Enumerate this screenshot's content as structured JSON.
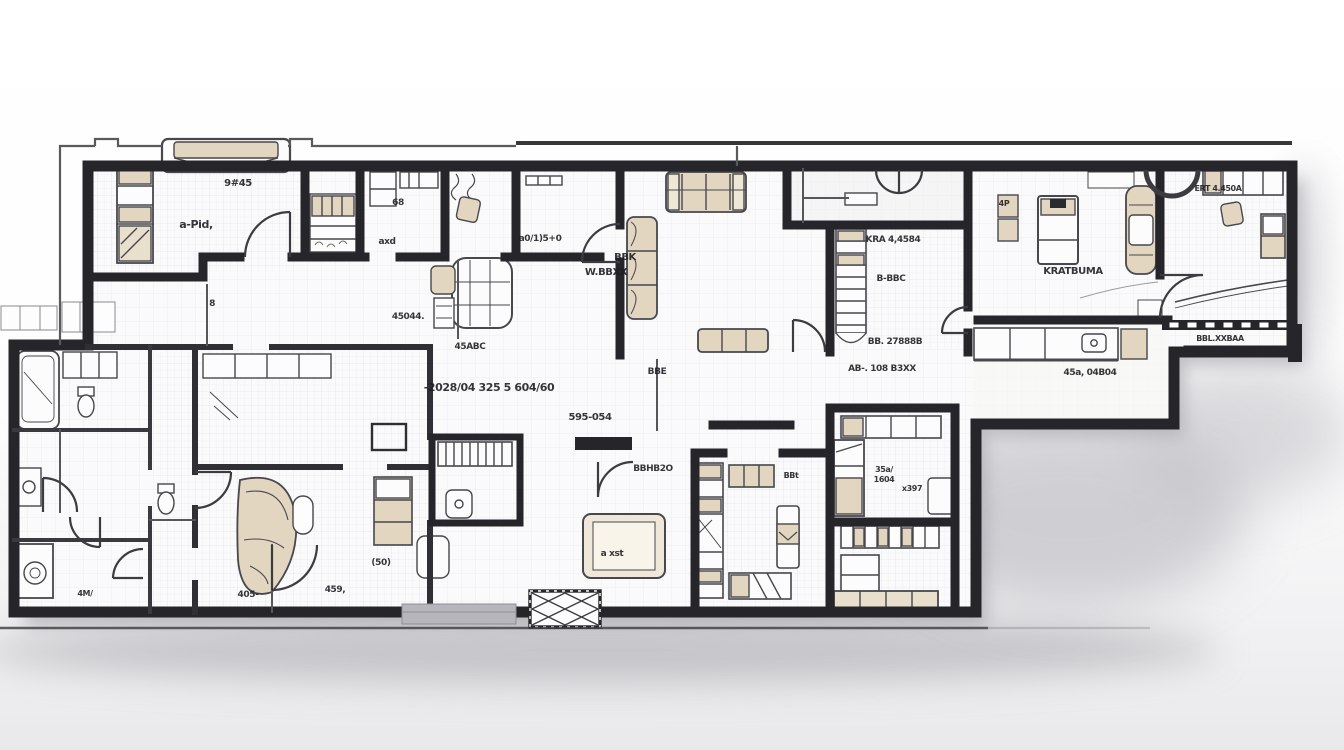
{
  "meta": {
    "title": "Hand-sketched apartment floor plan"
  },
  "palette": {
    "wall": "#26262a",
    "wall_medium": "#3a3a3e",
    "thin_line": "#55555a",
    "floor": "#fbfafb",
    "grid": "#aebad2",
    "furniture_beige": "#e3d6c1",
    "furniture_tan": "#d8c7ab",
    "furniture_white": "#fcfcfd",
    "furniture_stroke": "#47474c",
    "shadow": "#9b9ba1",
    "threshold_gray": "#b6b6bc",
    "label_ink": "#1e1e22"
  },
  "floorplan": {
    "labels": [
      {
        "name": "label-bedroom1-dim",
        "text": "9#45",
        "x": 238,
        "y": 186,
        "size": 10
      },
      {
        "name": "label-bedroom1-name",
        "text": "a-Pid,",
        "x": 196,
        "y": 228,
        "size": 11
      },
      {
        "name": "label-small-wc",
        "text": "8",
        "x": 212,
        "y": 306,
        "size": 9
      },
      {
        "name": "label-study-dim",
        "text": "68",
        "x": 398,
        "y": 205,
        "size": 9
      },
      {
        "name": "label-study-name",
        "text": "axd",
        "x": 387,
        "y": 244,
        "size": 9
      },
      {
        "name": "label-closet-room",
        "text": "a0/1)5+0",
        "x": 540,
        "y": 241,
        "size": 9
      },
      {
        "name": "label-dining-a",
        "text": "45044.",
        "x": 408,
        "y": 319,
        "size": 9
      },
      {
        "name": "label-dining-b",
        "text": "45ABC",
        "x": 470,
        "y": 349,
        "size": 9
      },
      {
        "name": "label-living-a",
        "text": "BBK",
        "x": 625,
        "y": 260,
        "size": 10
      },
      {
        "name": "label-living-b",
        "text": "W.BBXX",
        "x": 606,
        "y": 275,
        "size": 10
      },
      {
        "name": "label-stair-a",
        "text": "KRA 4,4584",
        "x": 893,
        "y": 242,
        "size": 9
      },
      {
        "name": "label-stair-b",
        "text": "B-BBC",
        "x": 891,
        "y": 281,
        "size": 9
      },
      {
        "name": "label-stair-c",
        "text": "BB. 27888B",
        "x": 895,
        "y": 344,
        "size": 9
      },
      {
        "name": "label-corridor",
        "text": "AB-. 108 B3XX",
        "x": 882,
        "y": 371,
        "size": 9
      },
      {
        "name": "label-bedroom2",
        "text": "KRATBUMA",
        "x": 1073,
        "y": 274,
        "size": 10
      },
      {
        "name": "label-bedroom2-door",
        "text": "4P",
        "x": 1004,
        "y": 206,
        "size": 8
      },
      {
        "name": "label-wing-top",
        "text": "ERT 4.450A",
        "x": 1218,
        "y": 191,
        "size": 8
      },
      {
        "name": "label-wing-bottom",
        "text": "BBL.XXBAA",
        "x": 1220,
        "y": 341,
        "size": 8
      },
      {
        "name": "label-kitchen",
        "text": "45a, 04B04",
        "x": 1090,
        "y": 375,
        "size": 9
      },
      {
        "name": "label-hall-main",
        "text": "-2028/04 325 5 604/60",
        "x": 489,
        "y": 391,
        "size": 11
      },
      {
        "name": "label-hall-b",
        "text": "595-054",
        "x": 590,
        "y": 420,
        "size": 10
      },
      {
        "name": "label-hall-c",
        "text": "BBE",
        "x": 657,
        "y": 374,
        "size": 9
      },
      {
        "name": "label-wc-door",
        "text": "BBHB2O",
        "x": 653,
        "y": 471,
        "size": 9
      },
      {
        "name": "label-tv-unit",
        "text": "a xst",
        "x": 612,
        "y": 556,
        "size": 9
      },
      {
        "name": "label-bedroom3",
        "text": "BBt",
        "x": 791,
        "y": 478,
        "size": 8
      },
      {
        "name": "label-pantry-a",
        "text": "(50)",
        "x": 381,
        "y": 565,
        "size": 9
      },
      {
        "name": "label-pantry-b",
        "text": "459,",
        "x": 335,
        "y": 592,
        "size": 9
      },
      {
        "name": "label-pantry-c",
        "text": "405-",
        "x": 248,
        "y": 597,
        "size": 9
      },
      {
        "name": "label-left-wing",
        "text": "4M/",
        "x": 85,
        "y": 596,
        "size": 8
      },
      {
        "name": "label-kidsroom-a",
        "text": "35a/",
        "x": 884,
        "y": 472,
        "size": 8
      },
      {
        "name": "label-kidsroom-b",
        "text": "1604",
        "x": 884,
        "y": 482,
        "size": 8
      },
      {
        "name": "label-kidsroom-c",
        "text": "x397",
        "x": 912,
        "y": 491,
        "size": 8
      }
    ]
  }
}
